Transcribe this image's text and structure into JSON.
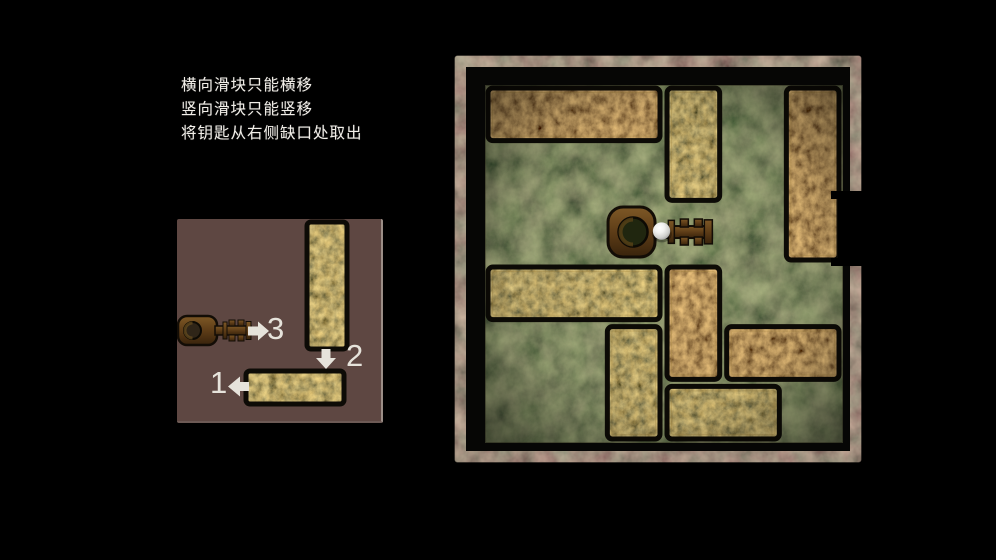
{
  "instructions": {
    "lines": [
      "横向滑块只能横移",
      "竖向滑块只能竖移",
      "将钥匙从右侧缺口处取出"
    ]
  },
  "hint_panel": {
    "steps": [
      {
        "label": "1",
        "target": "horizontal-slider",
        "direction": "left"
      },
      {
        "label": "2",
        "target": "vertical-slider",
        "direction": "down"
      },
      {
        "label": "3",
        "target": "key",
        "direction": "right"
      }
    ],
    "blocks": [
      {
        "id": "vertical-slider",
        "x": 130,
        "y": 3,
        "w": 40,
        "h": 127,
        "orientation": "vertical"
      },
      {
        "id": "horizontal-slider",
        "x": 69,
        "y": 152,
        "w": 98,
        "h": 33,
        "orientation": "horizontal"
      }
    ],
    "background_color": "#5e4742"
  },
  "board": {
    "grid": {
      "cols": 6,
      "rows": 6
    },
    "blocks": [
      {
        "id": "top-left",
        "col": 0,
        "row": 0,
        "w": 3,
        "h": 1,
        "orientation": "horizontal"
      },
      {
        "id": "top-mid",
        "col": 3,
        "row": 0,
        "w": 1,
        "h": 2,
        "orientation": "vertical"
      },
      {
        "id": "right-tall",
        "col": 5,
        "row": 0,
        "w": 1,
        "h": 3,
        "orientation": "vertical"
      },
      {
        "id": "mid-left",
        "col": 0,
        "row": 3,
        "w": 3,
        "h": 1,
        "orientation": "horizontal"
      },
      {
        "id": "mid-center",
        "col": 3,
        "row": 3,
        "w": 1,
        "h": 2,
        "orientation": "vertical"
      },
      {
        "id": "lower-center",
        "col": 2,
        "row": 4,
        "w": 1,
        "h": 2,
        "orientation": "vertical"
      },
      {
        "id": "mid-right",
        "col": 4,
        "row": 4,
        "w": 2,
        "h": 1,
        "orientation": "horizontal"
      },
      {
        "id": "bottom-mid",
        "col": 3,
        "row": 5,
        "w": 2,
        "h": 1,
        "orientation": "horizontal"
      }
    ],
    "key": {
      "col": 2,
      "row": 2,
      "w": 2,
      "h": 1,
      "marker": "white-ball"
    },
    "notch": {
      "side": "right",
      "row": 2
    },
    "colors": {
      "rust": "#7a5a26",
      "swamp": "#3a3a22",
      "frame_black": "#060605",
      "frame_texture": "#57453a"
    }
  },
  "colors": {
    "background": "#000000",
    "text": "#f2efe9",
    "arrow": "#e6e3db"
  }
}
